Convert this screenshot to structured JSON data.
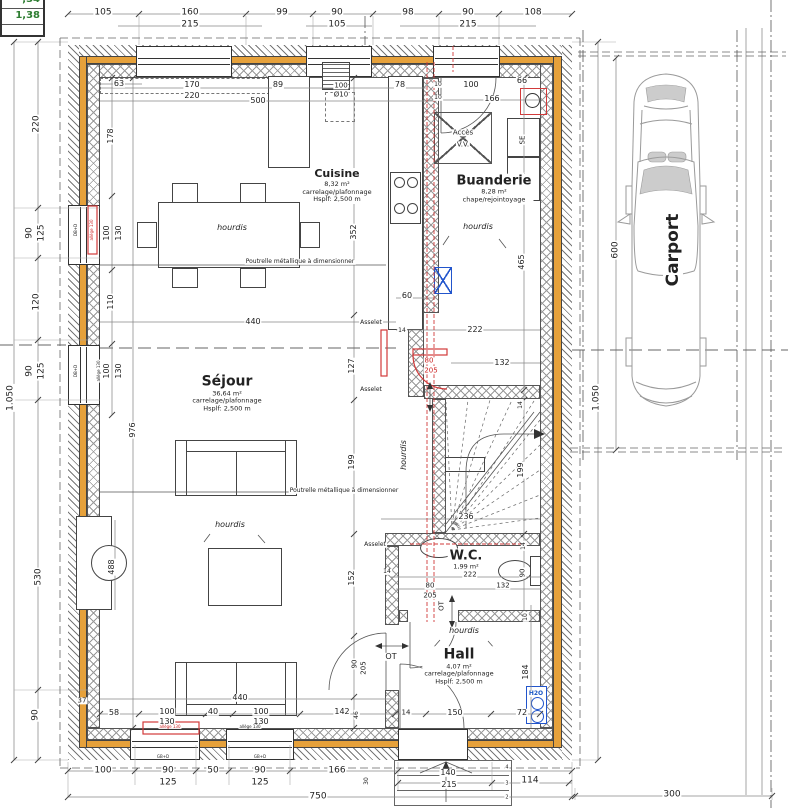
{
  "colors": {
    "insulation_orange": "#e6a13b",
    "pipe_red": "#d23a3a",
    "shaft_blue": "#2255cc",
    "water_blue": "#1a56c4",
    "survey_green": "#2e7d32"
  },
  "survey_box": {
    "row1": ",34",
    "row2": "1,38"
  },
  "rooms": [
    {
      "id": "cuisine",
      "name": "Cuisine",
      "area": "8,32 m²",
      "finish": "carrelage/plafonnage",
      "ceiling": "Hsplf: 2,500 m",
      "cx": 337,
      "cy": 186,
      "ns": 11
    },
    {
      "id": "buanderie",
      "name": "Buanderie",
      "area": "8,28 m²",
      "finish": "chape/rejointoyage",
      "cx": 494,
      "cy": 189,
      "ns": 13
    },
    {
      "id": "sejour",
      "name": "Séjour",
      "area": "36,64 m²",
      "finish": "carrelage/plafonnage",
      "ceiling": "Hsplf: 2,500 m",
      "cx": 227,
      "cy": 393,
      "ns": 14
    },
    {
      "id": "wc",
      "name": "W.C.",
      "area": "1,99 m²",
      "cx": 466,
      "cy": 560,
      "ns": 13
    },
    {
      "id": "hall",
      "name": "Hall",
      "area": "4,07 m²",
      "finish": "carrelage/plafonnage",
      "ceiling": "Hsplf: 2,500 m",
      "cx": 459,
      "cy": 666,
      "ns": 14
    },
    {
      "id": "carport",
      "name": "Carport",
      "cx": 673,
      "cy": 250,
      "ns": 17,
      "rot": -90
    }
  ],
  "dim_labels": [
    {
      "t": "105",
      "x": 103,
      "y": 13
    },
    {
      "t": "160",
      "x": 190,
      "y": 13
    },
    {
      "t": "215",
      "x": 190,
      "y": 25
    },
    {
      "t": "99",
      "x": 282,
      "y": 13
    },
    {
      "t": "90",
      "x": 337,
      "y": 13
    },
    {
      "t": "105",
      "x": 337,
      "y": 25
    },
    {
      "t": "98",
      "x": 408,
      "y": 13
    },
    {
      "t": "90",
      "x": 468,
      "y": 13
    },
    {
      "t": "215",
      "x": 468,
      "y": 25
    },
    {
      "t": "108",
      "x": 533,
      "y": 13
    },
    {
      "t": "63",
      "x": 119,
      "y": 84,
      "s": 8
    },
    {
      "t": "170",
      "x": 192,
      "y": 85,
      "s": 8
    },
    {
      "t": "220",
      "x": 192,
      "y": 96,
      "s": 8
    },
    {
      "t": "89",
      "x": 278,
      "y": 85,
      "s": 8
    },
    {
      "t": "500",
      "x": 258,
      "y": 101,
      "s": 8
    },
    {
      "t": "100",
      "x": 341,
      "y": 86,
      "s": 7
    },
    {
      "t": "Ø10",
      "x": 341,
      "y": 95,
      "s": 7
    },
    {
      "t": "78",
      "x": 400,
      "y": 85,
      "s": 8
    },
    {
      "t": "10",
      "x": 438,
      "y": 85,
      "s": 6
    },
    {
      "t": "100",
      "x": 471,
      "y": 85,
      "s": 8
    },
    {
      "t": "66",
      "x": 522,
      "y": 81,
      "s": 8
    },
    {
      "t": "10",
      "x": 438,
      "y": 98,
      "s": 6
    },
    {
      "t": "166",
      "x": 492,
      "y": 99,
      "s": 8
    },
    {
      "t": "1.050",
      "x": 11,
      "y": 398,
      "r": -90
    },
    {
      "t": "220",
      "x": 37,
      "y": 124,
      "r": -90
    },
    {
      "t": "90",
      "x": 30,
      "y": 233,
      "r": -90
    },
    {
      "t": "125",
      "x": 42,
      "y": 233,
      "r": -90
    },
    {
      "t": "120",
      "x": 37,
      "y": 302,
      "r": -90
    },
    {
      "t": "90",
      "x": 30,
      "y": 371,
      "r": -90
    },
    {
      "t": "125",
      "x": 42,
      "y": 371,
      "r": -90
    },
    {
      "t": "530",
      "x": 39,
      "y": 577,
      "r": -90
    },
    {
      "t": "90",
      "x": 36,
      "y": 715,
      "r": -90
    },
    {
      "t": "178",
      "x": 111,
      "y": 136,
      "r": -90,
      "s": 8
    },
    {
      "t": "100",
      "x": 107,
      "y": 233,
      "r": -90,
      "s": 8
    },
    {
      "t": "130",
      "x": 119,
      "y": 233,
      "r": -90,
      "s": 8
    },
    {
      "t": "110",
      "x": 111,
      "y": 302,
      "r": -90,
      "s": 8
    },
    {
      "t": "100",
      "x": 107,
      "y": 371,
      "r": -90,
      "s": 8
    },
    {
      "t": "130",
      "x": 119,
      "y": 371,
      "r": -90,
      "s": 8
    },
    {
      "t": "976",
      "x": 133,
      "y": 430,
      "r": -90,
      "s": 8
    },
    {
      "t": "488",
      "x": 112,
      "y": 567,
      "r": -90,
      "s": 8
    },
    {
      "t": "37",
      "x": 82,
      "y": 701,
      "s": 7
    },
    {
      "t": "352",
      "x": 354,
      "y": 232,
      "r": -90,
      "s": 8
    },
    {
      "t": "60",
      "x": 407,
      "y": 296,
      "s": 8
    },
    {
      "t": "14",
      "x": 402,
      "y": 331,
      "s": 6
    },
    {
      "t": "222",
      "x": 475,
      "y": 330,
      "s": 8
    },
    {
      "t": "132",
      "x": 502,
      "y": 363,
      "s": 8
    },
    {
      "t": "440",
      "x": 253,
      "y": 322,
      "s": 8
    },
    {
      "t": "127",
      "x": 352,
      "y": 366,
      "r": -90,
      "s": 8
    },
    {
      "t": "199",
      "x": 352,
      "y": 462,
      "r": -90,
      "s": 8
    },
    {
      "t": "152",
      "x": 352,
      "y": 578,
      "r": -90,
      "s": 8
    },
    {
      "t": "90",
      "x": 355,
      "y": 664,
      "r": -90,
      "s": 7
    },
    {
      "t": "205",
      "x": 364,
      "y": 668,
      "r": -90,
      "s": 7
    },
    {
      "t": "46",
      "x": 357,
      "y": 715,
      "r": -90,
      "s": 6
    },
    {
      "t": "465",
      "x": 522,
      "y": 262,
      "r": -90,
      "s": 8
    },
    {
      "t": "14",
      "x": 521,
      "y": 405,
      "r": -90,
      "s": 6
    },
    {
      "t": "199",
      "x": 521,
      "y": 470,
      "r": -90,
      "s": 8
    },
    {
      "t": "236",
      "x": 466,
      "y": 517,
      "s": 8
    },
    {
      "t": "222",
      "x": 470,
      "y": 575,
      "s": 7
    },
    {
      "t": "80",
      "x": 430,
      "y": 586,
      "s": 7
    },
    {
      "t": "205",
      "x": 430,
      "y": 596,
      "s": 7
    },
    {
      "t": "132",
      "x": 503,
      "y": 586,
      "s": 7
    },
    {
      "t": "90",
      "x": 523,
      "y": 573,
      "r": -90,
      "s": 7
    },
    {
      "t": "14",
      "x": 524,
      "y": 546,
      "r": -90,
      "s": 6
    },
    {
      "t": "10",
      "x": 526,
      "y": 617,
      "r": -90,
      "s": 6
    },
    {
      "t": "184",
      "x": 526,
      "y": 672,
      "r": -90,
      "s": 8
    },
    {
      "t": "14",
      "x": 387,
      "y": 572,
      "s": 6
    },
    {
      "t": "14",
      "x": 406,
      "y": 713,
      "s": 7
    },
    {
      "t": "150",
      "x": 455,
      "y": 713,
      "s": 8
    },
    {
      "t": "72",
      "x": 522,
      "y": 713,
      "s": 8
    },
    {
      "t": "58",
      "x": 114,
      "y": 713,
      "s": 8
    },
    {
      "t": "100",
      "x": 167,
      "y": 712,
      "s": 8
    },
    {
      "t": "130",
      "x": 167,
      "y": 722,
      "s": 8
    },
    {
      "t": "40",
      "x": 213,
      "y": 712,
      "s": 8
    },
    {
      "t": "100",
      "x": 261,
      "y": 712,
      "s": 8
    },
    {
      "t": "130",
      "x": 261,
      "y": 722,
      "s": 8
    },
    {
      "t": "142",
      "x": 342,
      "y": 712,
      "s": 8
    },
    {
      "t": "440",
      "x": 240,
      "y": 698,
      "s": 8
    },
    {
      "t": "100",
      "x": 103,
      "y": 771
    },
    {
      "t": "90",
      "x": 168,
      "y": 771
    },
    {
      "t": "125",
      "x": 168,
      "y": 783
    },
    {
      "t": "50",
      "x": 213,
      "y": 771
    },
    {
      "t": "90",
      "x": 260,
      "y": 771
    },
    {
      "t": "125",
      "x": 260,
      "y": 783
    },
    {
      "t": "166",
      "x": 337,
      "y": 771
    },
    {
      "t": "30",
      "x": 367,
      "y": 781,
      "r": -90,
      "s": 6
    },
    {
      "t": "750",
      "x": 318,
      "y": 797
    },
    {
      "t": "140",
      "x": 448,
      "y": 773,
      "s": 8
    },
    {
      "t": "215",
      "x": 449,
      "y": 785,
      "s": 8
    },
    {
      "t": "114",
      "x": 530,
      "y": 781
    },
    {
      "t": "300",
      "x": 672,
      "y": 795
    },
    {
      "t": "600",
      "x": 616,
      "y": 250,
      "r": -90
    },
    {
      "t": "1.050",
      "x": 597,
      "y": 398,
      "r": -90
    },
    {
      "t": "4",
      "x": 507,
      "y": 768,
      "s": 5
    },
    {
      "t": "3",
      "x": 507,
      "y": 784,
      "s": 5
    },
    {
      "t": "2",
      "x": 507,
      "y": 798,
      "s": 5
    },
    {
      "t": "80",
      "x": 429,
      "y": 361,
      "s": 7,
      "c": "red",
      "n": "future-door-width"
    },
    {
      "t": "205",
      "x": 431,
      "y": 371,
      "s": 7,
      "c": "red",
      "n": "future-door-height"
    }
  ],
  "annotations": [
    {
      "t": "hourdis",
      "x": 232,
      "y": 228,
      "s": 8,
      "i": 1,
      "n": "hourdis-label"
    },
    {
      "t": "hourdis",
      "x": 478,
      "y": 227,
      "s": 8,
      "i": 1,
      "n": "hourdis-label"
    },
    {
      "t": "hourdis",
      "x": 230,
      "y": 525,
      "s": 8,
      "i": 1,
      "n": "hourdis-label"
    },
    {
      "t": "hourdis",
      "x": 404,
      "y": 455,
      "s": 8,
      "i": 1,
      "r": -90,
      "n": "hourdis-label"
    },
    {
      "t": "hourdis",
      "x": 464,
      "y": 631,
      "s": 8,
      "i": 1,
      "n": "hourdis-label"
    },
    {
      "t": "Poutrelle métallique à dimensionner",
      "x": 300,
      "y": 262,
      "s": 6,
      "n": "steel-beam-note"
    },
    {
      "t": "Poutrelle métallique à dimensionner",
      "x": 344,
      "y": 491,
      "s": 6,
      "n": "steel-beam-note"
    },
    {
      "t": "Asselet",
      "x": 371,
      "y": 323,
      "s": 6,
      "n": "asselet-note"
    },
    {
      "t": "Asselet",
      "x": 371,
      "y": 390,
      "s": 6,
      "n": "asselet-note"
    },
    {
      "t": "Asselet",
      "x": 375,
      "y": 545,
      "s": 6,
      "n": "asselet-note"
    },
    {
      "t": "Accès",
      "x": 463,
      "y": 133,
      "s": 7,
      "n": "crawlspace-access-label"
    },
    {
      "t": "V.V.",
      "x": 463,
      "y": 145,
      "s": 7,
      "n": "crawlspace-access-label"
    },
    {
      "t": "SE",
      "x": 523,
      "y": 140,
      "s": 7,
      "r": -90,
      "n": "dryer-label"
    },
    {
      "t": "ML",
      "x": 523,
      "y": 179,
      "s": 8,
      "r": -90,
      "n": "washer-label"
    },
    {
      "t": "OT",
      "x": 391,
      "y": 657,
      "s": 8,
      "n": "ot-label"
    },
    {
      "t": "OT",
      "x": 442,
      "y": 606,
      "s": 7,
      "r": -90,
      "n": "ot-label"
    },
    {
      "t": "H2O",
      "x": 536,
      "y": 694,
      "s": 6,
      "b": 1,
      "c": "blue",
      "n": "water-meter-label"
    },
    {
      "t": "allège 130",
      "x": 92,
      "y": 230,
      "s": 4,
      "r": -90,
      "c": "red",
      "n": "sill-height-note"
    },
    {
      "t": "allège 130",
      "x": 99,
      "y": 371,
      "s": 4,
      "r": -90,
      "n": "sill-height-note"
    },
    {
      "t": "allège 130",
      "x": 170,
      "y": 727,
      "s": 4,
      "c": "red",
      "n": "sill-height-note"
    },
    {
      "t": "allège 130",
      "x": 250,
      "y": 727,
      "s": 4,
      "n": "sill-height-note"
    },
    {
      "t": "DB+D",
      "x": 76,
      "y": 230,
      "s": 4,
      "r": -90,
      "n": "window-type-note"
    },
    {
      "t": "DB+D",
      "x": 76,
      "y": 371,
      "s": 4,
      "r": -90,
      "n": "window-type-note"
    },
    {
      "t": "GB+D",
      "x": 163,
      "y": 757,
      "s": 4,
      "n": "window-type-note"
    },
    {
      "t": "GB+D",
      "x": 260,
      "y": 757,
      "s": 4,
      "n": "window-type-note"
    }
  ]
}
